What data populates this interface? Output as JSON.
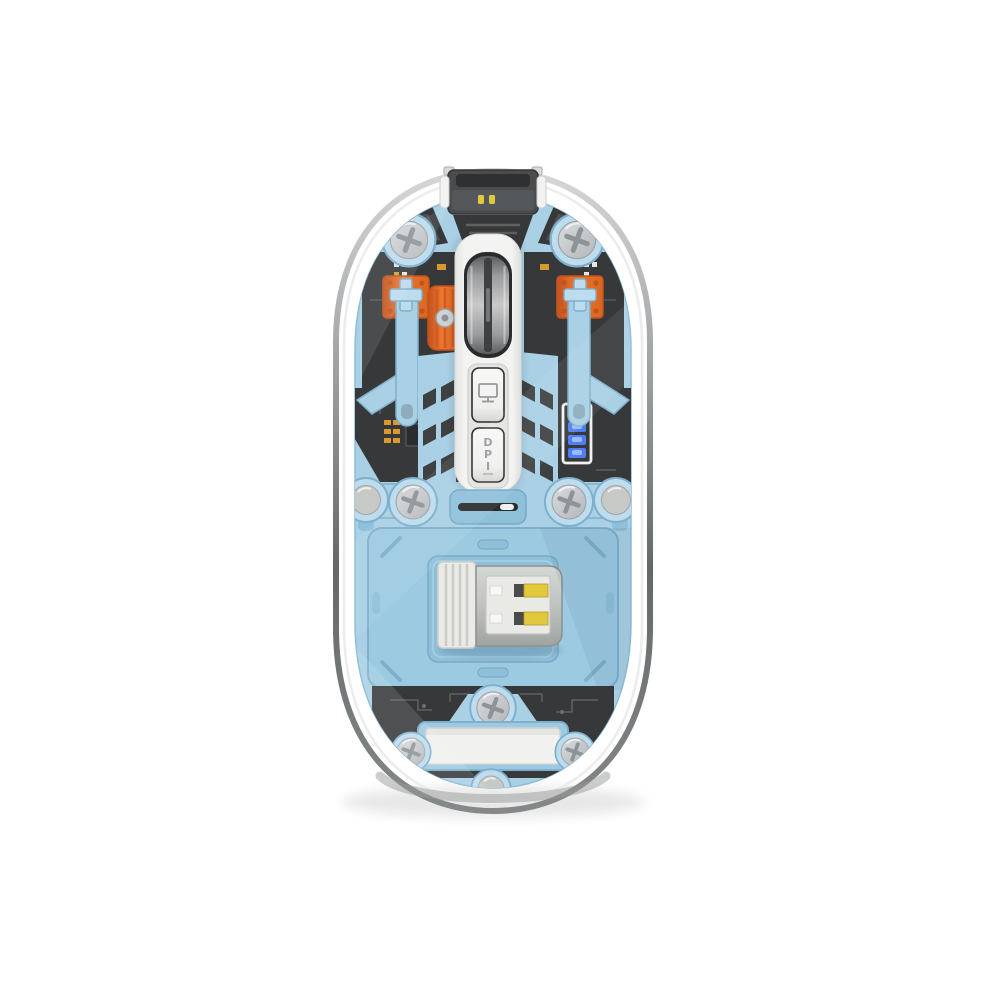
{
  "image": {
    "type": "product-photo",
    "subject": "Transparent wireless computer mouse, top-down view showing internal components",
    "background": "#ffffff"
  },
  "labels": {
    "dpi_button": "DPI",
    "dpi_letters": [
      "D",
      "P",
      "I"
    ]
  },
  "indicators": {
    "battery_segments_total": 4,
    "battery_segments_lit": 4
  },
  "icons": [
    {
      "name": "monitor-icon",
      "meaning": "connection mode button glyph"
    },
    {
      "name": "battery-icon",
      "meaning": "battery charge level indicator, 4 bars lit"
    },
    {
      "name": "phillips-screw-icon",
      "meaning": "cross-head screws"
    }
  ],
  "components": [
    "transparent-shell",
    "usb-c-charging-port",
    "scroll-wheel",
    "scroll-encoder",
    "left-click-switch",
    "right-click-switch",
    "mode-button",
    "dpi-button",
    "battery-indicator",
    "vent-slots",
    "usb-receiver-dongle",
    "base-plate",
    "nameplate",
    "phillips-screws",
    "mouse-feet",
    "pcb-boards",
    "power-switch-slot"
  ],
  "colors": {
    "shell_rim_light": "#d7d7d7",
    "shell_rim_mid": "#9fa4a7",
    "shell_rim_dark": "#636869",
    "chassis_blue": "#a9d0e5",
    "chassis_blue_light": "#c9e3f1",
    "chassis_blue_dark": "#7fafcb",
    "boss_blue": "#bddcee",
    "vent_blue": "#8fc0da",
    "pcb_dark": "#37383a",
    "pcb_trace": "#5d6164",
    "pad_gold": "#d8992f",
    "accent_orange": "#ec7430",
    "accent_orange_dark": "#c2531c",
    "strip_white": "#f3f3f1",
    "button_face": "#f8f8f6",
    "button_edge": "#2d2d2d",
    "icon_gray": "#979a9c",
    "wheel_dark": "#5d5e60",
    "wheel_mid": "#9b9c9e",
    "wheel_light": "#c9c9c9",
    "wheel_slot": "#3f4042",
    "screw_face": "#d9dcde",
    "screw_face_dark": "#b3b7ba",
    "screw_slot": "#8e9396",
    "foot_gray": "#c7c9c7",
    "led_blue": "#4f7ef2",
    "led_blue_light": "#9db9f8",
    "usb_metal_light": "#d4d8d4",
    "usb_metal_dark": "#a0a4a0",
    "usb_gold": "#e2c83d",
    "usb_white": "#eaeae7",
    "label_white": "#f1f1ef"
  }
}
